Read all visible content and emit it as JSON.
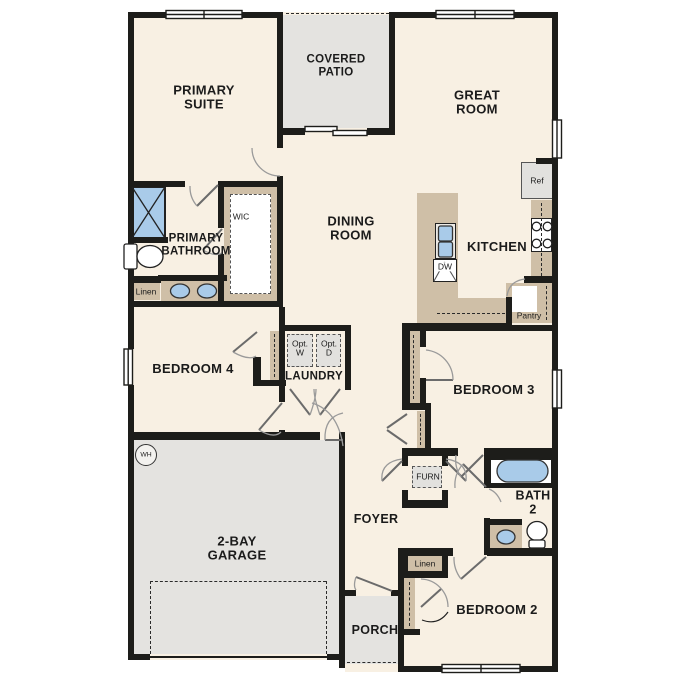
{
  "colors": {
    "wall": "#1d1d1a",
    "floor": "#f8f0e3",
    "hard": "#e4e3e0",
    "counter": "#cfbfa7",
    "appliance": "#e2e1de",
    "blue": "#a9cbe9",
    "dash": "#2a2a2a"
  },
  "labels": {
    "primary_suite": "PRIMARY\nSUITE",
    "covered_patio": "COVERED\nPATIO",
    "great_room": "GREAT\nROOM",
    "dining_room": "DINING\nROOM",
    "kitchen": "KITCHEN",
    "primary_bathroom": "PRIMARY\nBATHROOM",
    "wic": "WIC",
    "linen_bath": "Linen",
    "bedroom_4": "BEDROOM 4",
    "laundry": "LAUNDRY",
    "opt_washer": "Opt.\nW",
    "opt_dryer": "Opt.\nD",
    "refrigerator": "Ref",
    "dishwasher": "DW",
    "pantry": "Pantry",
    "bedroom_3": "BEDROOM 3",
    "furnace": "FURN",
    "foyer": "FOYER",
    "bath_2": "BATH\n2",
    "linen_hall": "Linen",
    "bedroom_2": "BEDROOM 2",
    "porch": "PORCH",
    "garage": "2-BAY\nGARAGE",
    "water_heater": "WH"
  }
}
